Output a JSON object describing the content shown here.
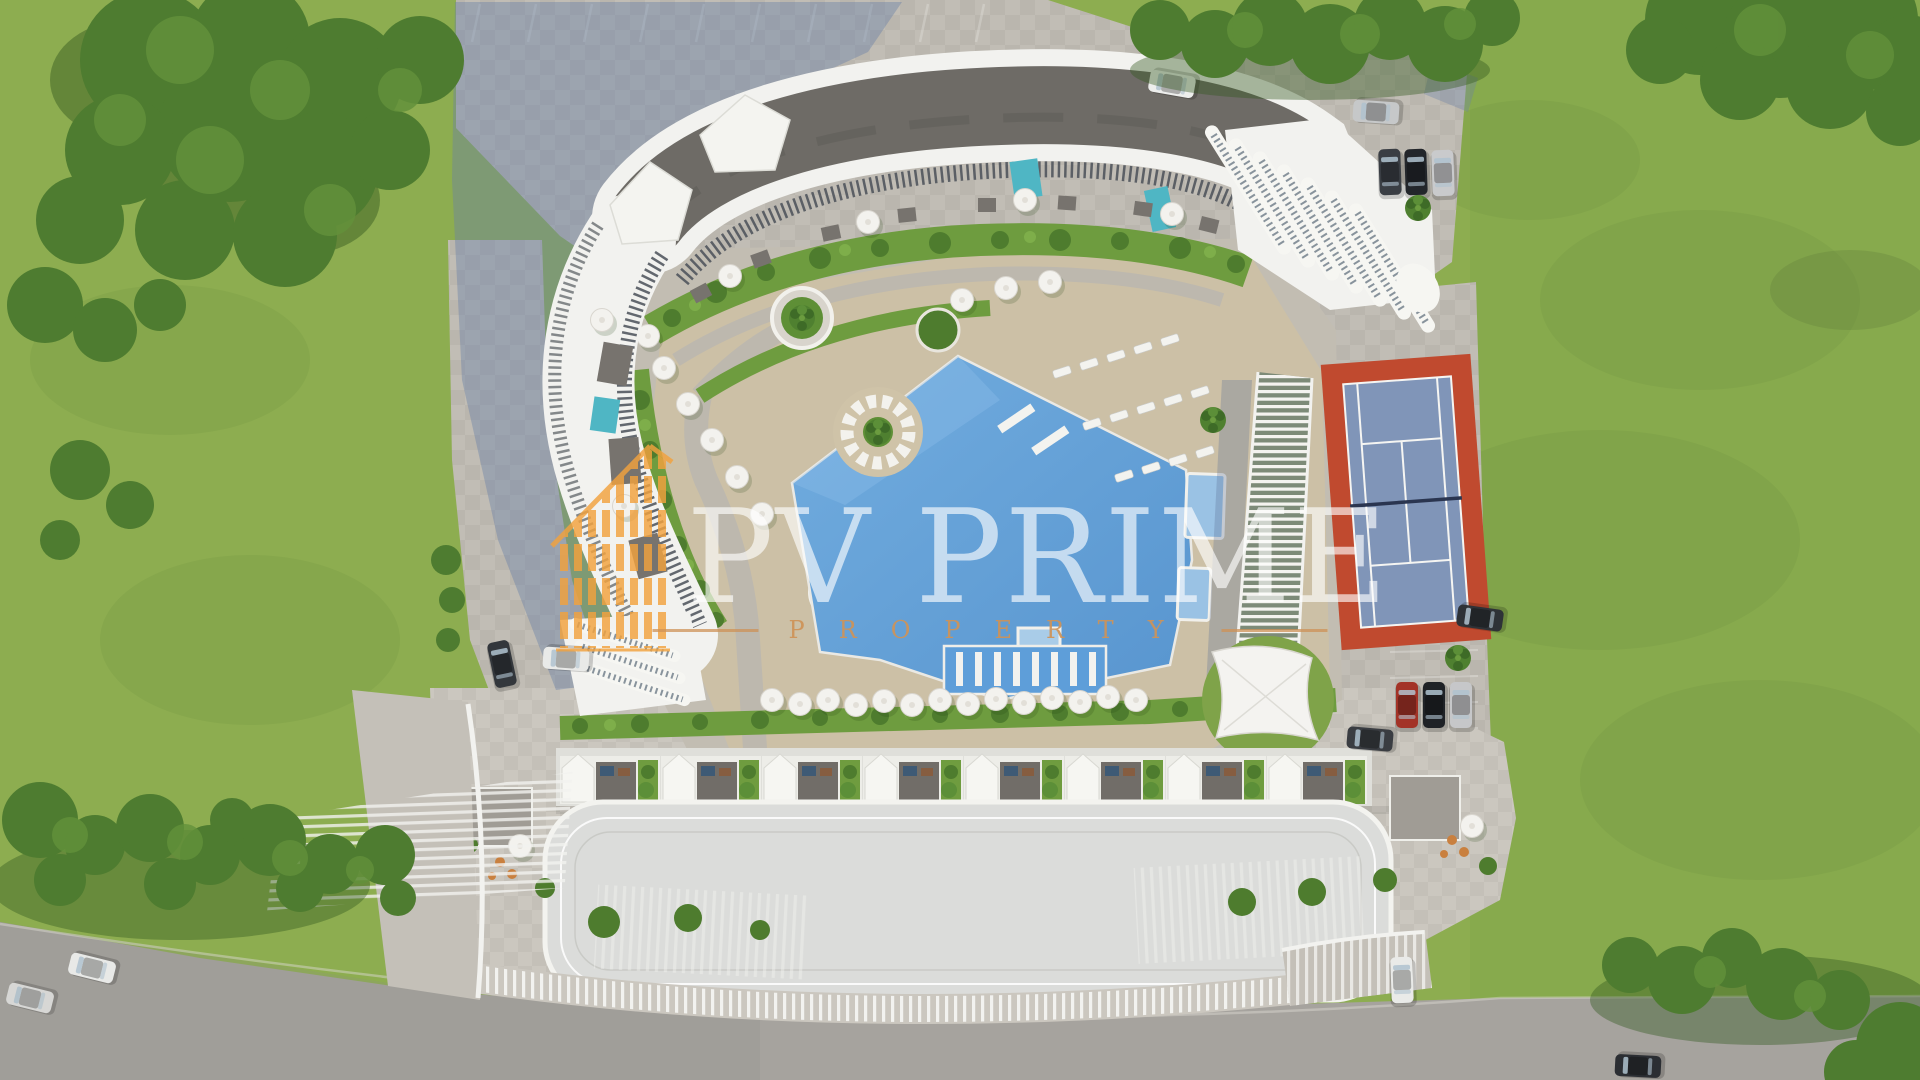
{
  "meta": {
    "description": "Aerial top-down 3D render of a residential complex site plan",
    "view": "top-down"
  },
  "watermark": {
    "title": "PV PRIME",
    "subtitle": "PROPERTY",
    "logo": "striped-highrise-outline",
    "title_color": "rgba(255,255,255,0.63)",
    "accent_color": "#CE9257",
    "logo_color": "#F2A23E"
  },
  "palette": {
    "grass": "#8DAD50",
    "grass_right": "#84A74B",
    "foliage_dark": "#3F6A28",
    "foliage": "#4E7C30",
    "foliage_light": "#63913B",
    "paving": "#C1BDB5",
    "plaza": "#CBC7BF",
    "asphalt": "#A6A39E",
    "roof_dark": "#6E6B66",
    "building_white": "#F2F2EF",
    "shadow_blue": "#6A80A6",
    "pool_water": "#65A4DB",
    "deck_tan": "#CCC0A6",
    "tennis_red": "#C04A2F",
    "tennis_blue": "#8095B8",
    "hedge_green": "#6E9C3F",
    "teal_pool": "#4FB6C4",
    "furniture_orange": "#C9803F"
  },
  "scene": {
    "amenities": [
      "curved-apartment-building",
      "swimming-pool",
      "pool-bar",
      "sun-loungers",
      "parasols",
      "pergola",
      "shade-sail",
      "tennis-court",
      "landscaped-gardens",
      "parking-areas",
      "long-terrace-building",
      "access-road"
    ],
    "vehicle_count": 16
  }
}
